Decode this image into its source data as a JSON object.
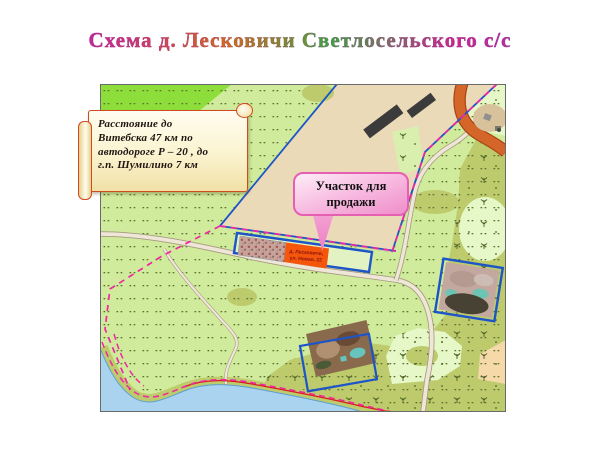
{
  "title": "Схема  д. Лесковичи Светлосельского с/с",
  "banner": {
    "line1": "Расстояние  до",
    "line2": "Витебска  47 км по",
    "line3": "автодороге  Р – 20 ,  до",
    "line4": "г.п. Шумилино 7 км"
  },
  "callout": {
    "text": "Участок  для продажи"
  },
  "sale_plot": {
    "line1": "д. Лесковичи,",
    "line2": "ул. Новая, 22"
  },
  "colors": {
    "title_gradient_core": "#c9288c",
    "meadow_green": "#cfeb9b",
    "bright_green": "#8ede3b",
    "olive_green": "#bdcb6d",
    "pale_mint": "#e6f7c8",
    "field_beige": "#ebdab8",
    "sale_plot_orange": "#f4570c",
    "boundary_blue": "#1d55c8",
    "boundary_pink_dashed": "#f226a2",
    "shore_red_line": "#d81c1c",
    "water_blue": "#aad3ef",
    "road_orange": "#d4662a",
    "banner_border": "#cf4a1f",
    "callout_pink": "#f8bfe2",
    "callout_border": "#e560b2"
  }
}
